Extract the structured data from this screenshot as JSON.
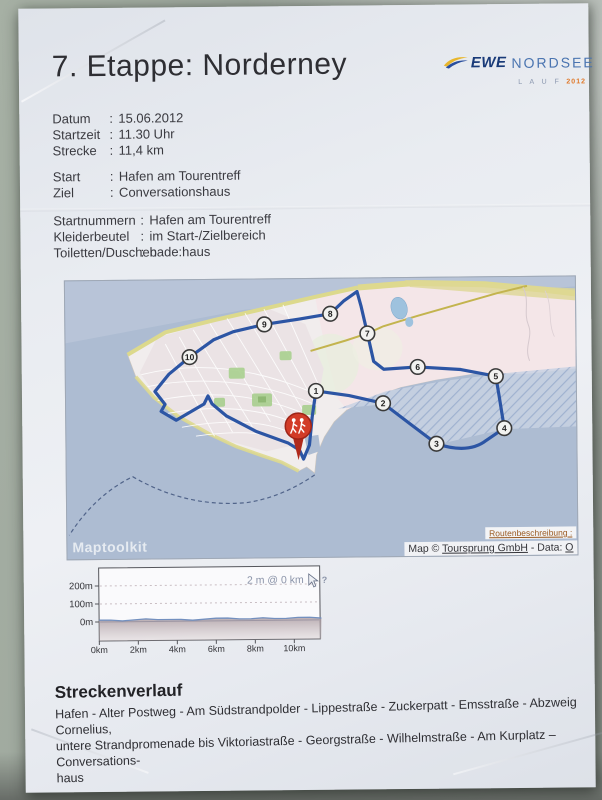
{
  "title": "7. Etappe: Norderney",
  "logo": {
    "brand": "EWE",
    "name": "NORDSEE",
    "sub": "L A U F",
    "year": "2012",
    "brand_color": "#193a78",
    "accent_color": "#e07828"
  },
  "info_rows": {
    "colon": ":",
    "block1": [
      {
        "label": "Datum",
        "value": "15.06.2012"
      },
      {
        "label": "Startzeit",
        "value": "11.30 Uhr"
      },
      {
        "label": "Strecke",
        "value": "11,4 km"
      }
    ],
    "block2": [
      {
        "label": "Start",
        "value": "Hafen am Tourentreff"
      },
      {
        "label": "Ziel",
        "value": "Conversationshaus"
      }
    ],
    "block3": [
      {
        "label": "Startnummern",
        "value": "Hafen am Tourentreff"
      },
      {
        "label": "Kleiderbeutel",
        "value": "im Start-/Zielbereich"
      },
      {
        "label": "Toiletten/Duschen",
        "value": "bade:haus"
      }
    ]
  },
  "map": {
    "watermark": "Maptoolkit",
    "route_link": "Routenbeschreibung :",
    "attribution": {
      "prefix": "Map © ",
      "link1": "Toursprung GmbH",
      "mid": " - Data: ",
      "link2": "O"
    },
    "start_marker": "red pin with two runner figures at Hafen am Tourentreff",
    "route_color": "#2c55a4",
    "sea_color": "#adbcd2",
    "pin_color": "#d23b27",
    "waypoints": [
      {
        "n": "1",
        "x": 250,
        "y": 112
      },
      {
        "n": "2",
        "x": 317,
        "y": 125
      },
      {
        "n": "3",
        "x": 370,
        "y": 166
      },
      {
        "n": "4",
        "x": 438,
        "y": 151
      },
      {
        "n": "5",
        "x": 430,
        "y": 99
      },
      {
        "n": "6",
        "x": 352,
        "y": 89
      },
      {
        "n": "7",
        "x": 302,
        "y": 55
      },
      {
        "n": "8",
        "x": 265,
        "y": 35
      },
      {
        "n": "9",
        "x": 199,
        "y": 45
      },
      {
        "n": "10",
        "x": 124,
        "y": 77
      }
    ]
  },
  "chart_data": {
    "type": "area",
    "title": "",
    "tooltip": "2 m @ 0 km",
    "x_ticks": [
      "0km",
      "2km",
      "4km",
      "6km",
      "8km",
      "10km"
    ],
    "y_ticks": [
      "200m",
      "100m",
      "0m"
    ],
    "x_range_km": [
      0,
      11.4
    ],
    "y_range_m": [
      0,
      250
    ],
    "grid": "dashed horizontal lines at 100m and 200m, solid baseline at 0m",
    "legend_position": "none",
    "series": [
      {
        "name": "elevation",
        "x_km": [
          0,
          0.6,
          1.2,
          1.8,
          2.4,
          3,
          3.6,
          4.2,
          4.8,
          5.4,
          6,
          6.6,
          7.2,
          7.8,
          8.4,
          9,
          9.6,
          10.2,
          10.8,
          11.4
        ],
        "y_m": [
          2,
          2,
          1,
          2,
          3,
          2,
          2,
          2,
          1,
          2,
          3,
          3,
          2,
          2,
          3,
          2,
          2,
          3,
          3,
          2
        ]
      }
    ]
  },
  "strecke": {
    "heading": "Streckenverlauf",
    "lines": [
      "Hafen - Alter Postweg - Am Südstrandpolder - Lippestraße - Zuckerpatt - Emsstraße - Abzweig Cornelius,",
      "untere Strandpromenade bis Viktoriastraße - Georgstraße - Wilhelmstraße - Am Kurplatz – Conversations-",
      "haus"
    ]
  }
}
